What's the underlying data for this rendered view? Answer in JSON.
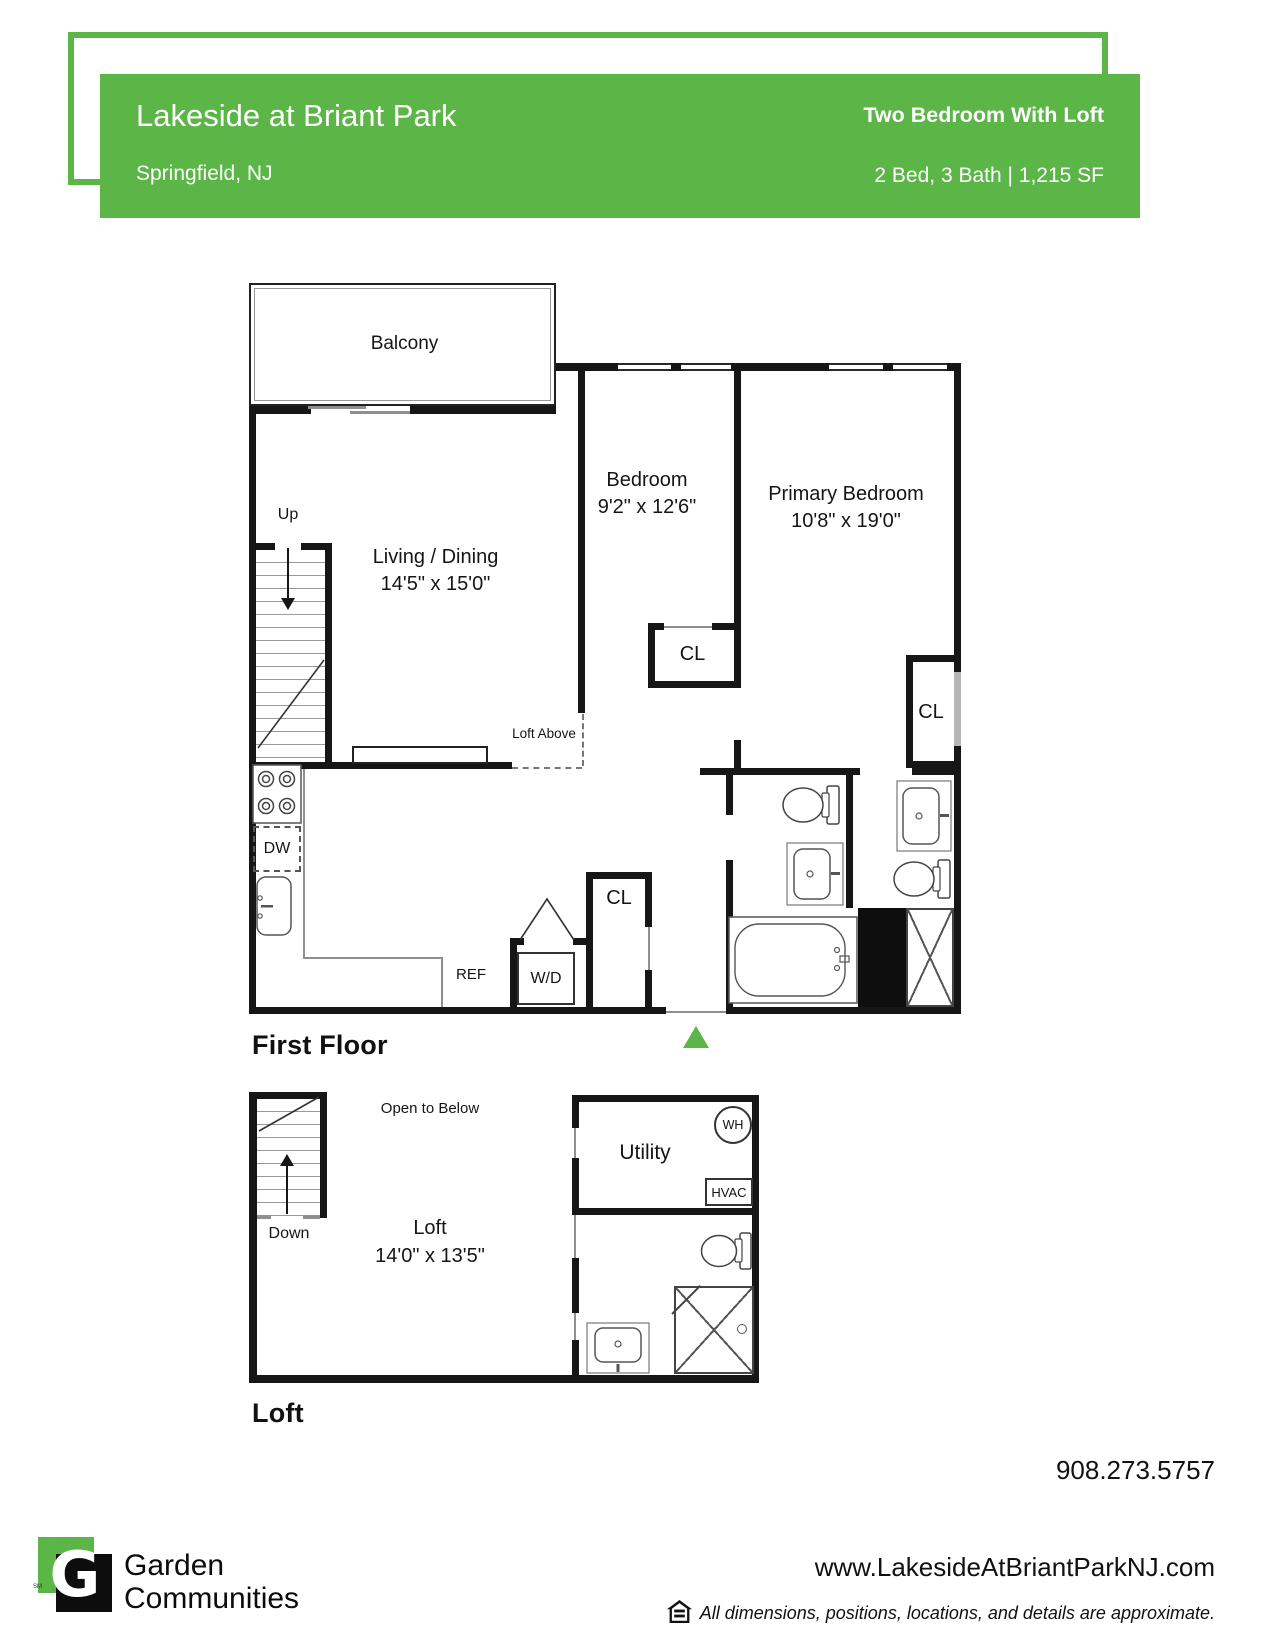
{
  "header": {
    "property_name": "Lakeside at Briant Park",
    "location": "Springfield, NJ",
    "plan_type": "Two Bedroom With Loft",
    "plan_specs": "2 Bed, 3 Bath | 1,215 SF",
    "accent_color": "#5bb647"
  },
  "first_floor": {
    "title": "First Floor",
    "balcony": "Balcony",
    "living_name": "Living / Dining",
    "living_dims": "14'5\" x 15'0\"",
    "bedroom_name": "Bedroom",
    "bedroom_dims": "9'2\" x 12'6\"",
    "primary_name": "Primary Bedroom",
    "primary_dims": "10'8\" x 19'0\"",
    "up": "Up",
    "loft_above": "Loft Above",
    "cl_bedroom": "CL",
    "cl_primary": "CL",
    "cl_entry": "CL",
    "dw": "DW",
    "ref": "REF",
    "wd": "W/D"
  },
  "loft": {
    "title": "Loft",
    "open_to_below": "Open to Below",
    "room_name": "Loft",
    "room_dims": "14'0\" x 13'5\"",
    "down": "Down",
    "utility": "Utility",
    "wh": "WH",
    "hvac": "HVAC"
  },
  "footer": {
    "brand_line1": "Garden",
    "brand_line2": "Communities",
    "trademark": "SM",
    "logo_letter": "G",
    "phone": "908.273.5757",
    "website": "www.LakesideAtBriantParkNJ.com",
    "disclaimer": "All dimensions, positions, locations, and details are approximate."
  }
}
